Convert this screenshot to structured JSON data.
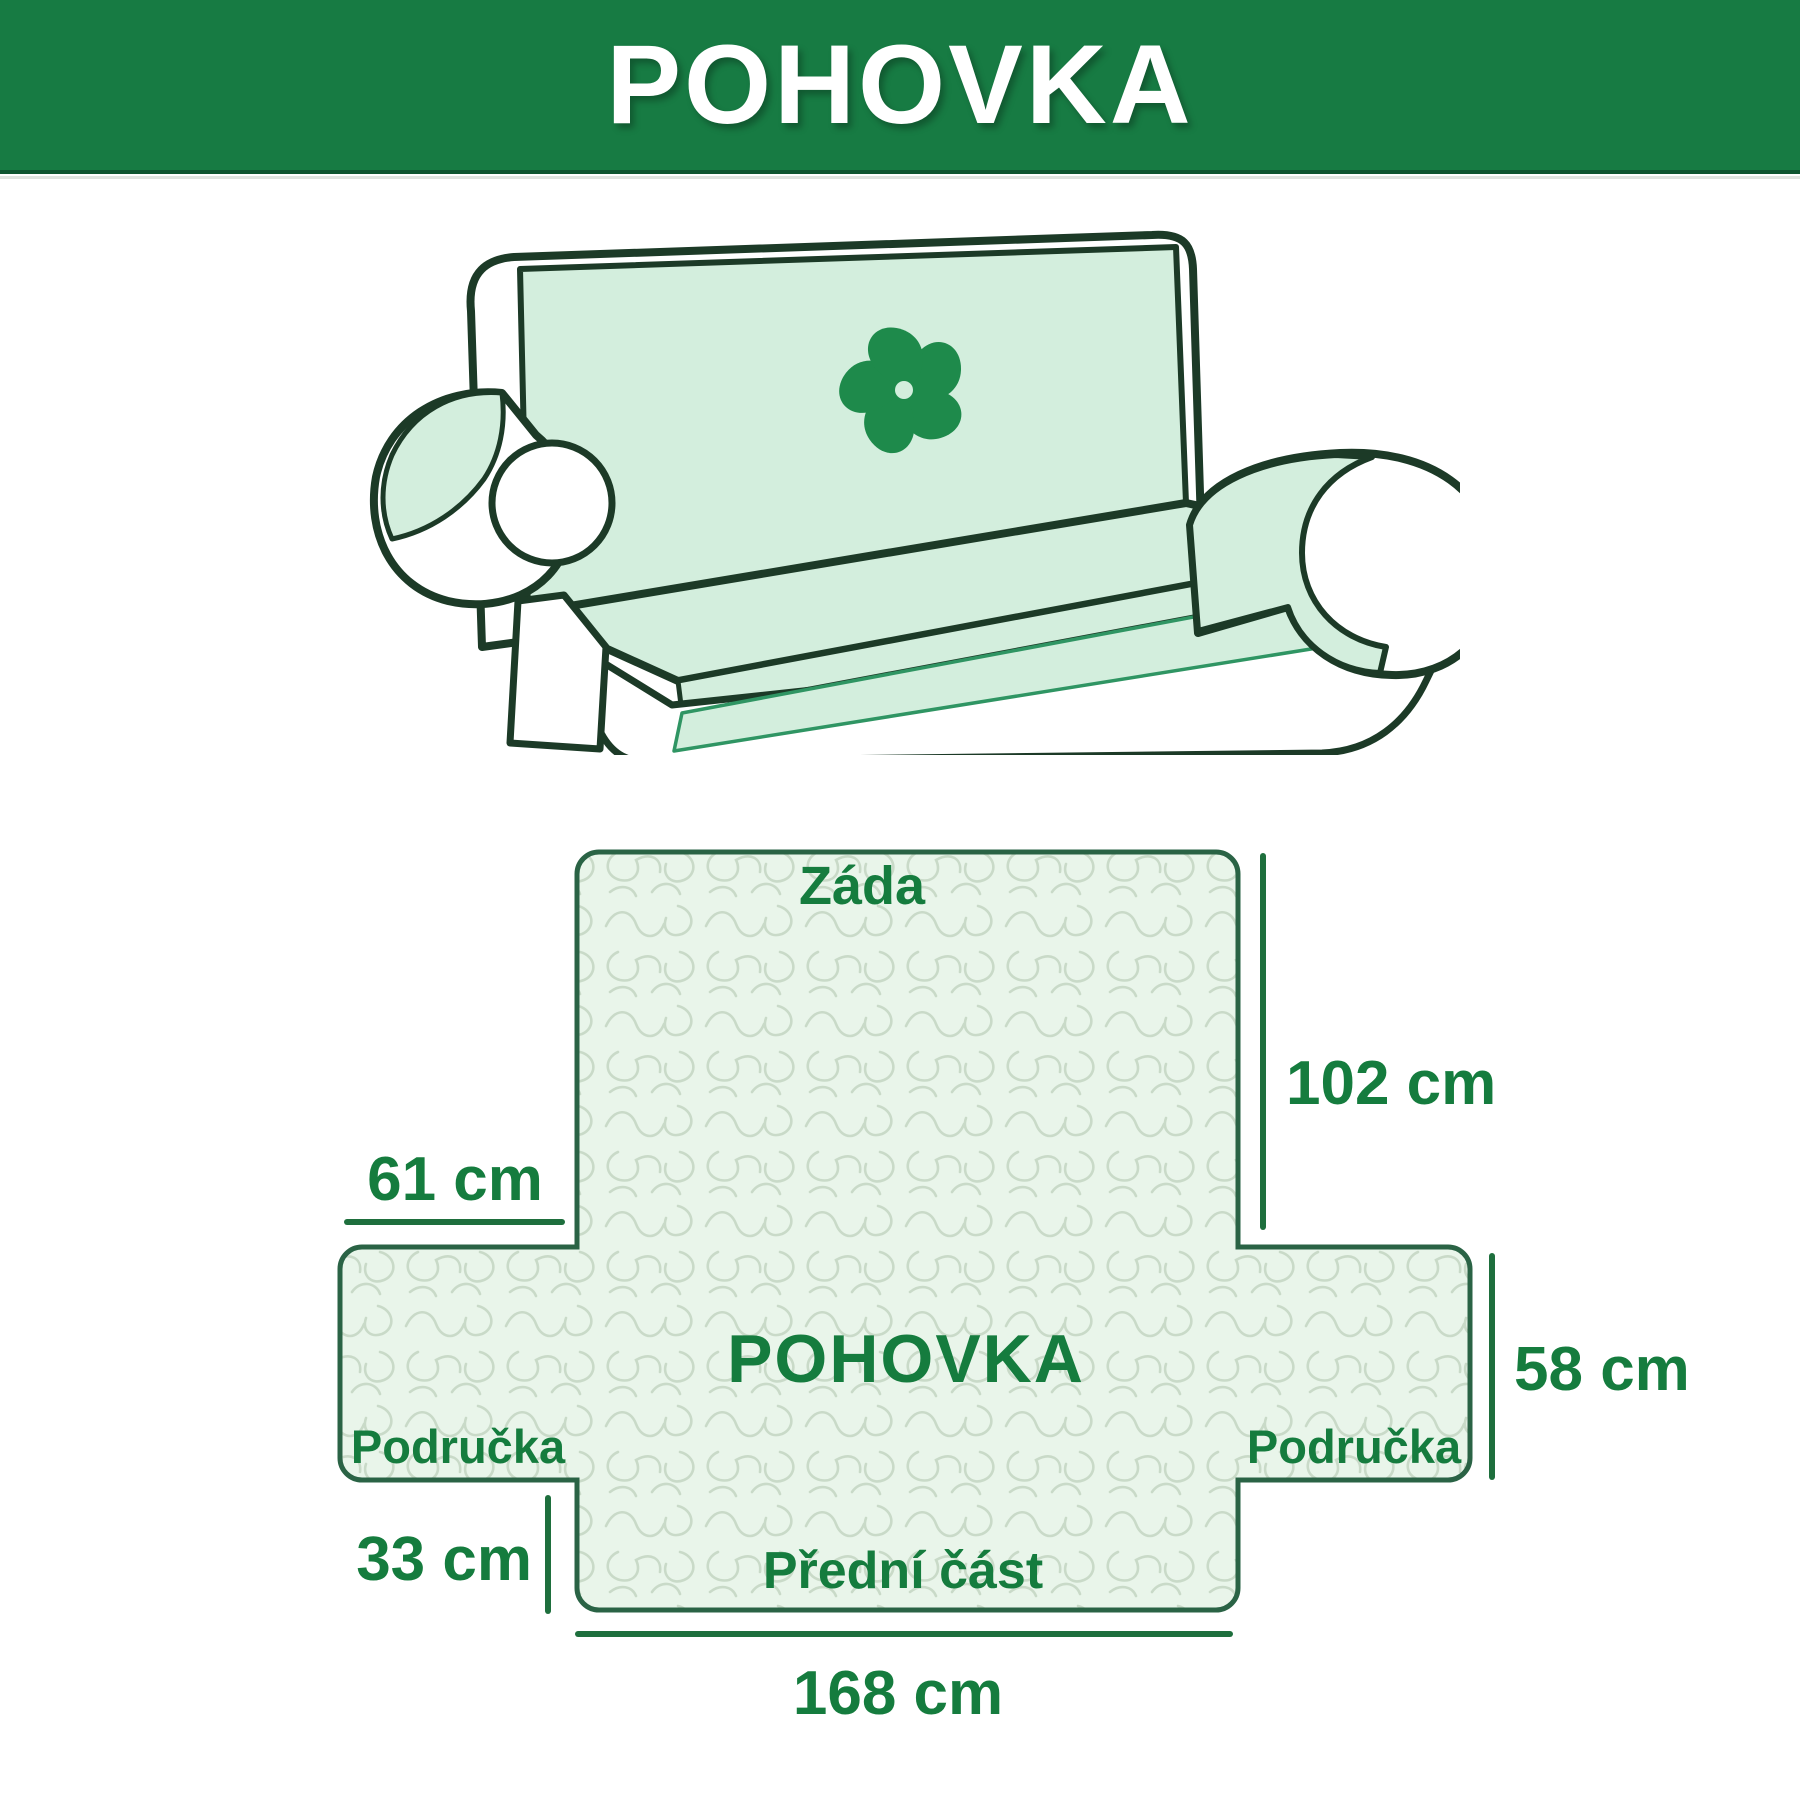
{
  "header": {
    "title": "POHOVKA",
    "background_color": "#177b43",
    "text_color": "#ffffff"
  },
  "illustration": {
    "description": "line drawing of two-seat sofa with mint protective cover and pinwheel logo",
    "cover_color": "#d3eedd",
    "outline_color": "#1c3a27",
    "logo": "pinwheel-flower",
    "logo_color": "#1e8a4b"
  },
  "diagram": {
    "center_label": "POHOVKA",
    "sections": {
      "back": "Záda",
      "front": "Přední část",
      "left_arm": "Područka",
      "right_arm": "Područka"
    },
    "measurements": {
      "back_height": "102 cm",
      "arm_flap_width": "61 cm",
      "arm_flap_height": "58 cm",
      "front_skirt_height": "33 cm",
      "total_width": "168 cm"
    },
    "colors": {
      "border": "#2a6345",
      "fill": "#e9f5ea",
      "pattern_line": "#c9dac8",
      "label": "#157c3e",
      "measure_line": "#1e6f3d"
    }
  }
}
